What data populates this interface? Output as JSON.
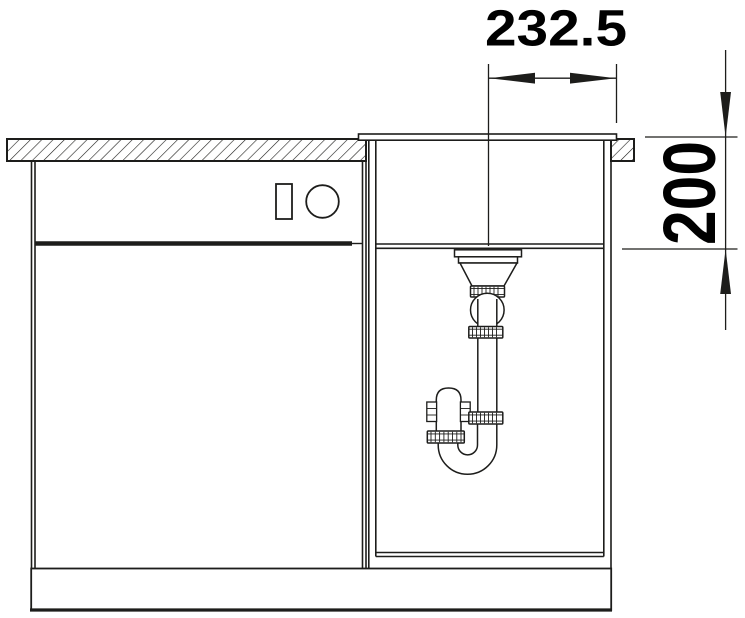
{
  "drawing": {
    "dimensions": {
      "horizontal": "232.5",
      "vertical": "200"
    },
    "colors": {
      "line": "#1d1d1b",
      "text": "#000000",
      "background": "#ffffff"
    }
  }
}
